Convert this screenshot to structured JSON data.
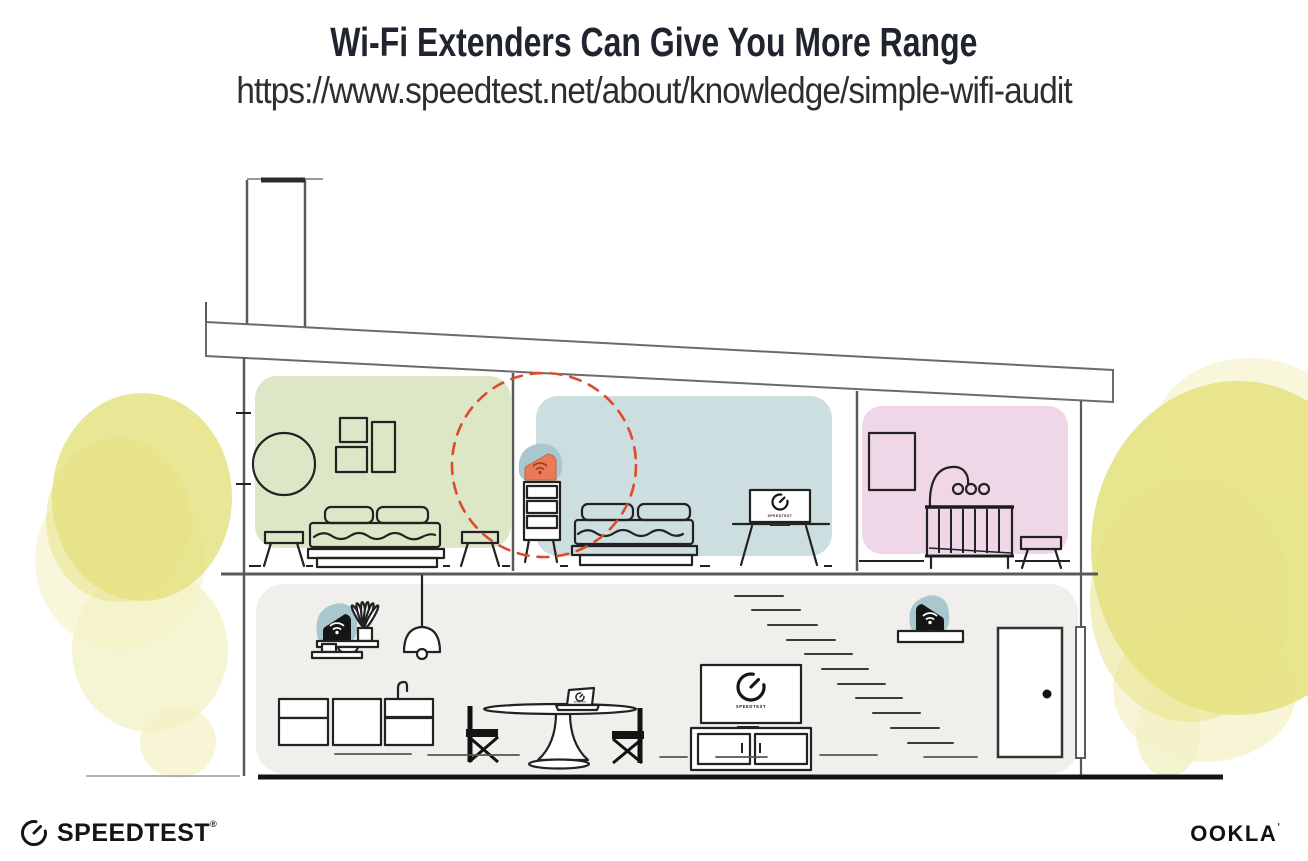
{
  "header": {
    "title": "Wi-Fi Extenders Can Give You More Range",
    "url": "https://www.speedtest.net/about/knowledge/simple-wifi-audit"
  },
  "illustration": {
    "screens": {
      "speedtest_label": "SPEEDTEST"
    },
    "icons": {
      "wifi": "wifi-arcs-icon",
      "speedtest_gauge": "gauge-needle-icon"
    },
    "colors": {
      "accent-red": "#DC4B2C",
      "room-green": "#DDE7C8",
      "room-blue": "#CDDEE1",
      "room-pink": "#F0D7E7",
      "floor-gray": "#F0EFEB",
      "blob-teal": "#A9C7CE",
      "extender-orange": "#EC7A57",
      "wifi-on-orange": "#A63C1E",
      "watercolor-yellow": "#E5E283",
      "watercolor-yellow-light": "#F3F1C4",
      "title-navy": "#20242E"
    }
  },
  "footer": {
    "speedtest_wordmark": "SPEEDTEST",
    "speedtest_reg_mark": "®",
    "ookla_wordmark": "OOKLA",
    "ookla_mark": "ʼ"
  }
}
